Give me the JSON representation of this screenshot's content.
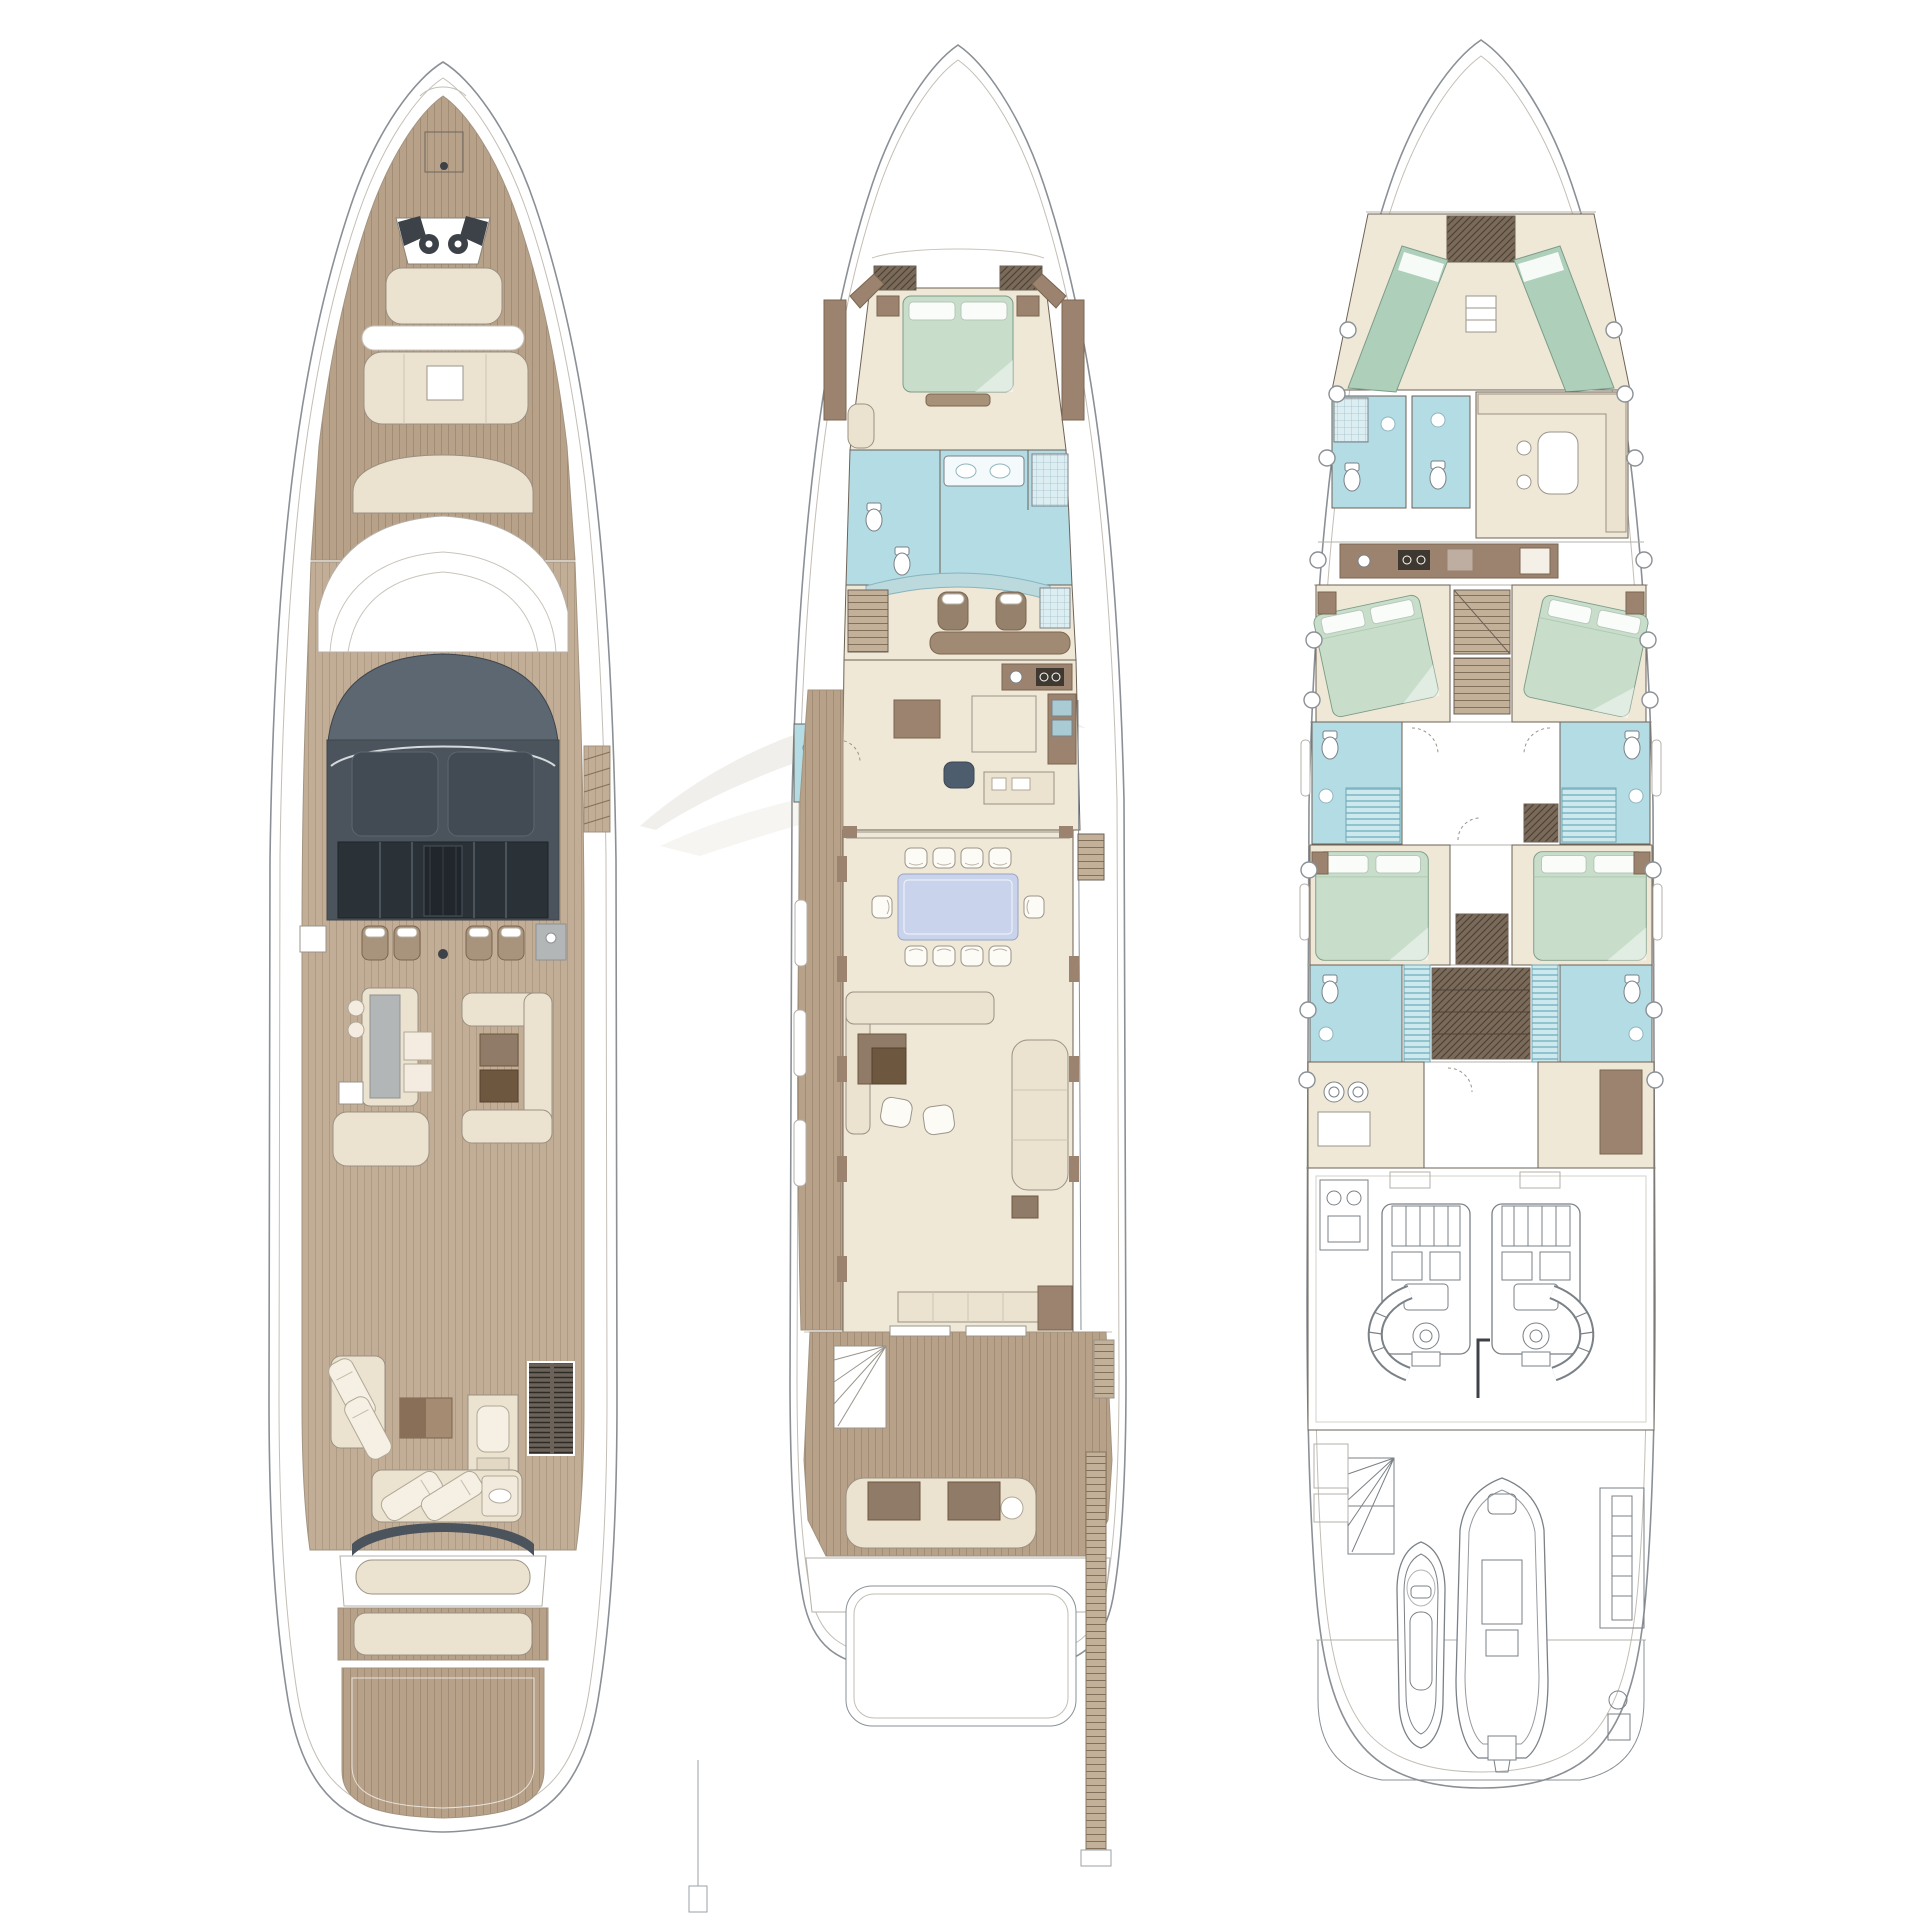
{
  "diagram": {
    "type": "yacht general arrangement deck plans",
    "plans": [
      {
        "position": "left",
        "deck": "exterior / sun deck view",
        "features": [
          "bow pulpit",
          "anchor windlasses",
          "foredeck teak",
          "bow sunpad",
          "forward settee with table",
          "observation seat",
          "dark hardtop with skylights",
          "four flybridge helm seats",
          "wet bar unit",
          "bar island with stools",
          "U-shaped lounge with coffee tables",
          "aft sun loungers",
          "louvered vent",
          "aft sunpad",
          "teak swim platform"
        ]
      },
      {
        "position": "center",
        "deck": "main deck",
        "features": [
          "owner cabin with double bed and wardrobes",
          "en-suite bathroom with twin sinks and shower",
          "wheelhouse with two helm seats and chart table",
          "staircase",
          "galley with cooktop and island",
          "day head",
          "dining table with ten chairs",
          "main salon with L-sofa, coffee tables, armchairs and chaise",
          "sideboard",
          "aft cockpit bench with fan staircase",
          "lowered swim platform",
          "side passerelle"
        ]
      },
      {
        "position": "right",
        "deck": "lower deck",
        "features": [
          "crew V-berth cabin with wardrobe",
          "two crew bathrooms",
          "crew mess with corner bench",
          "crew galley",
          "two forward guest cabins with angled double beds",
          "central staircases",
          "two mid bathrooms with showers",
          "two aft guest cabins with double beds",
          "aft bathroom band with central sauna/stair block",
          "laundry / utility rooms",
          "engine room with twin engines and control cabinet",
          "garage with fan stairs, jet ski, tender and crane",
          "transom platform",
          "portholes along both sides"
        ]
      }
    ],
    "counts": {
      "deck_plans": 3,
      "flybridge_helm_seats": 4,
      "dining_chairs": 10,
      "guest_cabins_lower_deck": 4,
      "crew_berths": 2,
      "engines": 2,
      "jet_skis": 1,
      "tenders": 1
    }
  },
  "colors": {
    "hull-stroke": "#8a9096",
    "teak": "#b7a189",
    "teak-lt": "#c2ad96",
    "cream": "#ece2d0",
    "brown": "#9b8370",
    "slate": "#4b545c",
    "green": "#c8decb",
    "green-crew": "#aecfba",
    "blue": "#b3dce4",
    "peri": "#c9d3ec",
    "gray-furn": "#b2b6b7",
    "paper": "#ffffff"
  }
}
